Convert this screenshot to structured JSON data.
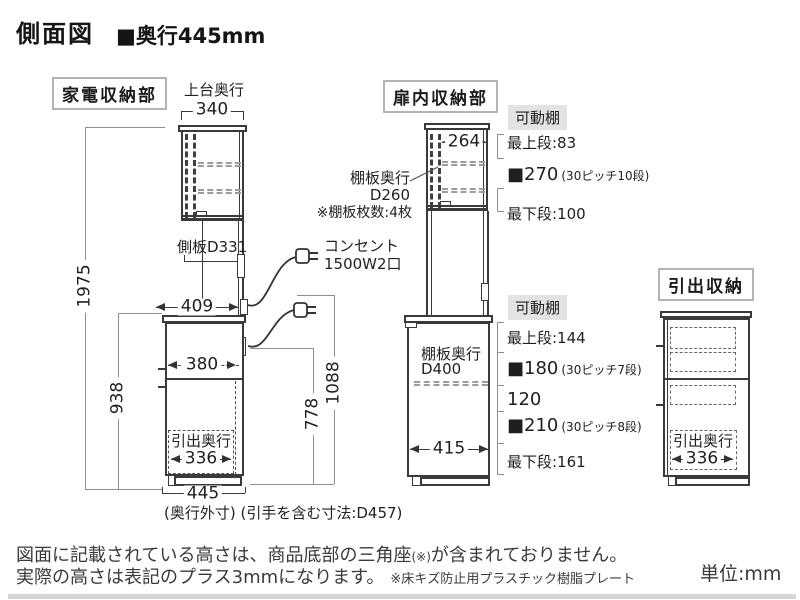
{
  "header": {
    "title": "側面図",
    "depth_spec": "■奥行445mm"
  },
  "sections": {
    "appliance": {
      "label": "家電収納部",
      "top_depth_caption": "上台奥行",
      "dim_340": "340",
      "dim_1975": "1975",
      "side_panel_label": "側板D331",
      "dim_409": "409",
      "dim_938": "938",
      "dim_380": "380",
      "dim_778": "778",
      "dim_1088": "1088",
      "outlet_line1": "コンセント",
      "outlet_line2": "1500W2口",
      "drawer_depth_caption": "引出奥行",
      "dim_336": "336",
      "dim_445": "445",
      "bottom_note": "(奥行外寸) (引手を含む寸法:D457)"
    },
    "door": {
      "label": "扉内収納部",
      "dim_264": "264",
      "shelf_caption_1": "棚板奥行",
      "shelf_caption_2": "D260",
      "shelf_caption_3": "※棚板枚数:4枚",
      "upper_tag": "可動棚",
      "upper_rows": [
        {
          "text": "最上段:83"
        },
        {
          "value": "■270",
          "pitch": "(30ピッチ10段)"
        },
        {
          "text": "最下段:100"
        }
      ],
      "lower_tag": "可動棚",
      "lower_shelf_caption_1": "棚板奥行",
      "lower_shelf_caption_2": "D400",
      "dim_415": "415",
      "lower_rows": [
        {
          "text": "最上段:144"
        },
        {
          "value": "■180",
          "pitch": "(30ピッチ7段)"
        },
        {
          "text": "120"
        },
        {
          "value": "■210",
          "pitch": "(30ピッチ8段)"
        },
        {
          "text": "最下段:161"
        }
      ]
    },
    "drawer": {
      "label": "引出収納",
      "drawer_depth_caption": "引出奥行",
      "dim_336": "336"
    }
  },
  "footer": {
    "note1_a": "図面に記載されている高さは、商品底部の三角座",
    "note1_small": "(※)",
    "note1_b": "が含まれておりません。",
    "note2_a": "実際の高さは表記のプラス3mmになります。",
    "note2_small": "※床キズ防止用プラスチック樹脂プレート",
    "unit": "単位:mm"
  }
}
